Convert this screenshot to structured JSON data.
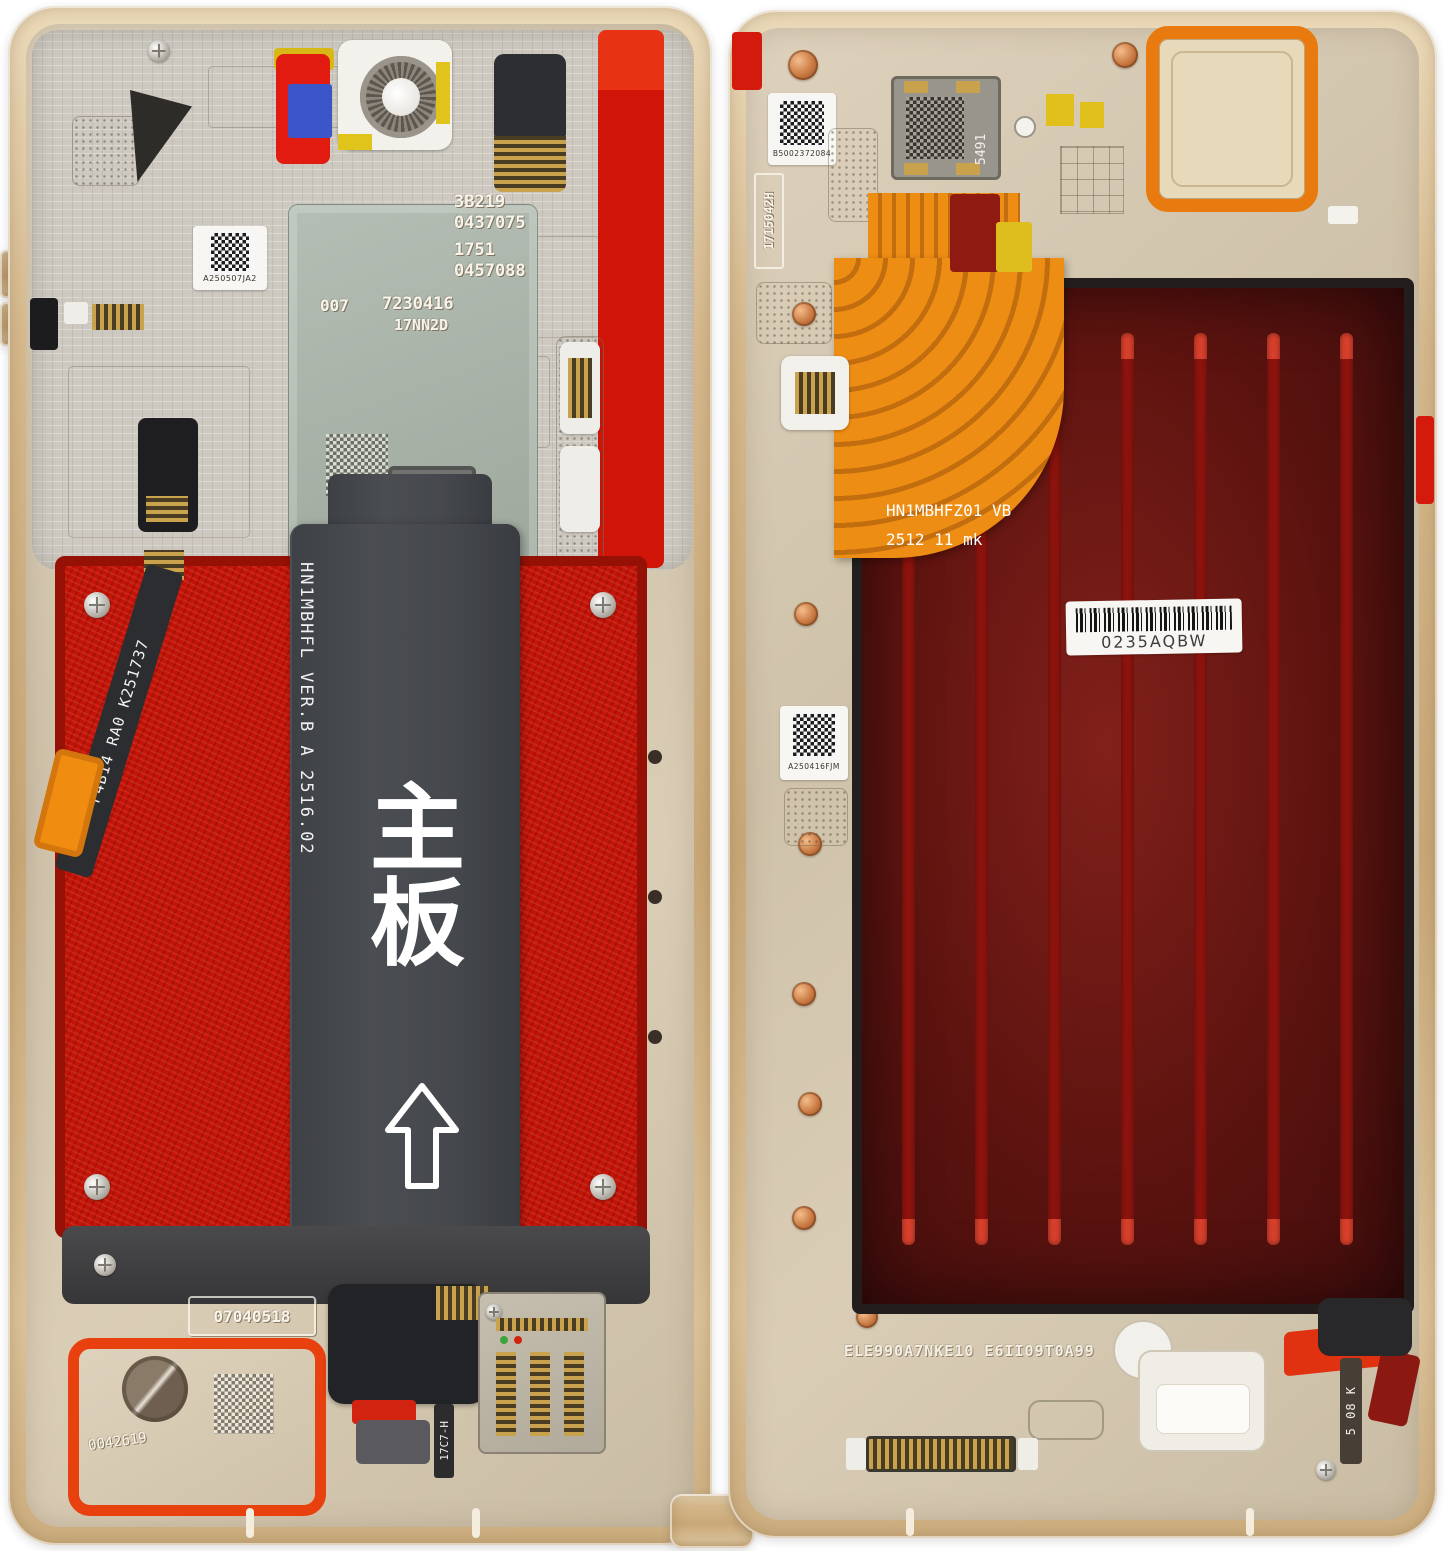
{
  "scene": {
    "description": "Disassembled foldable smartphone: two gold internal frame halves with main-board flex, battery adhesive, display back panel and labels",
    "background": "#ffffff"
  },
  "colors": {
    "gold_frame": "#d3b488",
    "champagne_plate": "#d6c9b2",
    "shield_silver": "#cdc9c1",
    "shield_green": "#a9b3ab",
    "adhesive_red": "#c51407",
    "display_maroon": "#6b1511",
    "display_stripe": "#8e140e",
    "flex_black": "#45484d",
    "flex_orange": "#ee8d14",
    "gasket_orange_red": "#e8400e",
    "sticker_teal": "#2fb5b2",
    "sticker_blue": "#3a56c8",
    "screw_copper": "#c87840"
  },
  "left": {
    "qr_top": "A250507JA2",
    "etch_block1_line1": "3B219",
    "etch_block1_line2": "0437075",
    "etch_block2_line1": "1751",
    "etch_block2_line2": "0457088",
    "etch_007": "007",
    "etch_main1": "7230416",
    "etch_main2": "17NN2D",
    "flex_code_vertical": "HN1MBHFL VER.B  A 2516.02",
    "main_board_cn": "主板",
    "diag_flex_code": "F4B14 RA0  K251737",
    "etch_box_bottom": "07040518",
    "speaker_etch": "0042619",
    "sim_flex_code": "17C7-H"
  },
  "right": {
    "qr_top": "B5002372084",
    "etch_vertical": "1715042H",
    "chip_code": "5491",
    "flex_line1": "HN1MBHFZ01 VB",
    "flex_line2": "2512 11  mk",
    "barcode_text": "0235AQBW",
    "qr_mid": "A250416FJM",
    "bottom_etch": "ELE990A7NKE10 E6II09T0A99",
    "side_code": "5 08 K"
  }
}
